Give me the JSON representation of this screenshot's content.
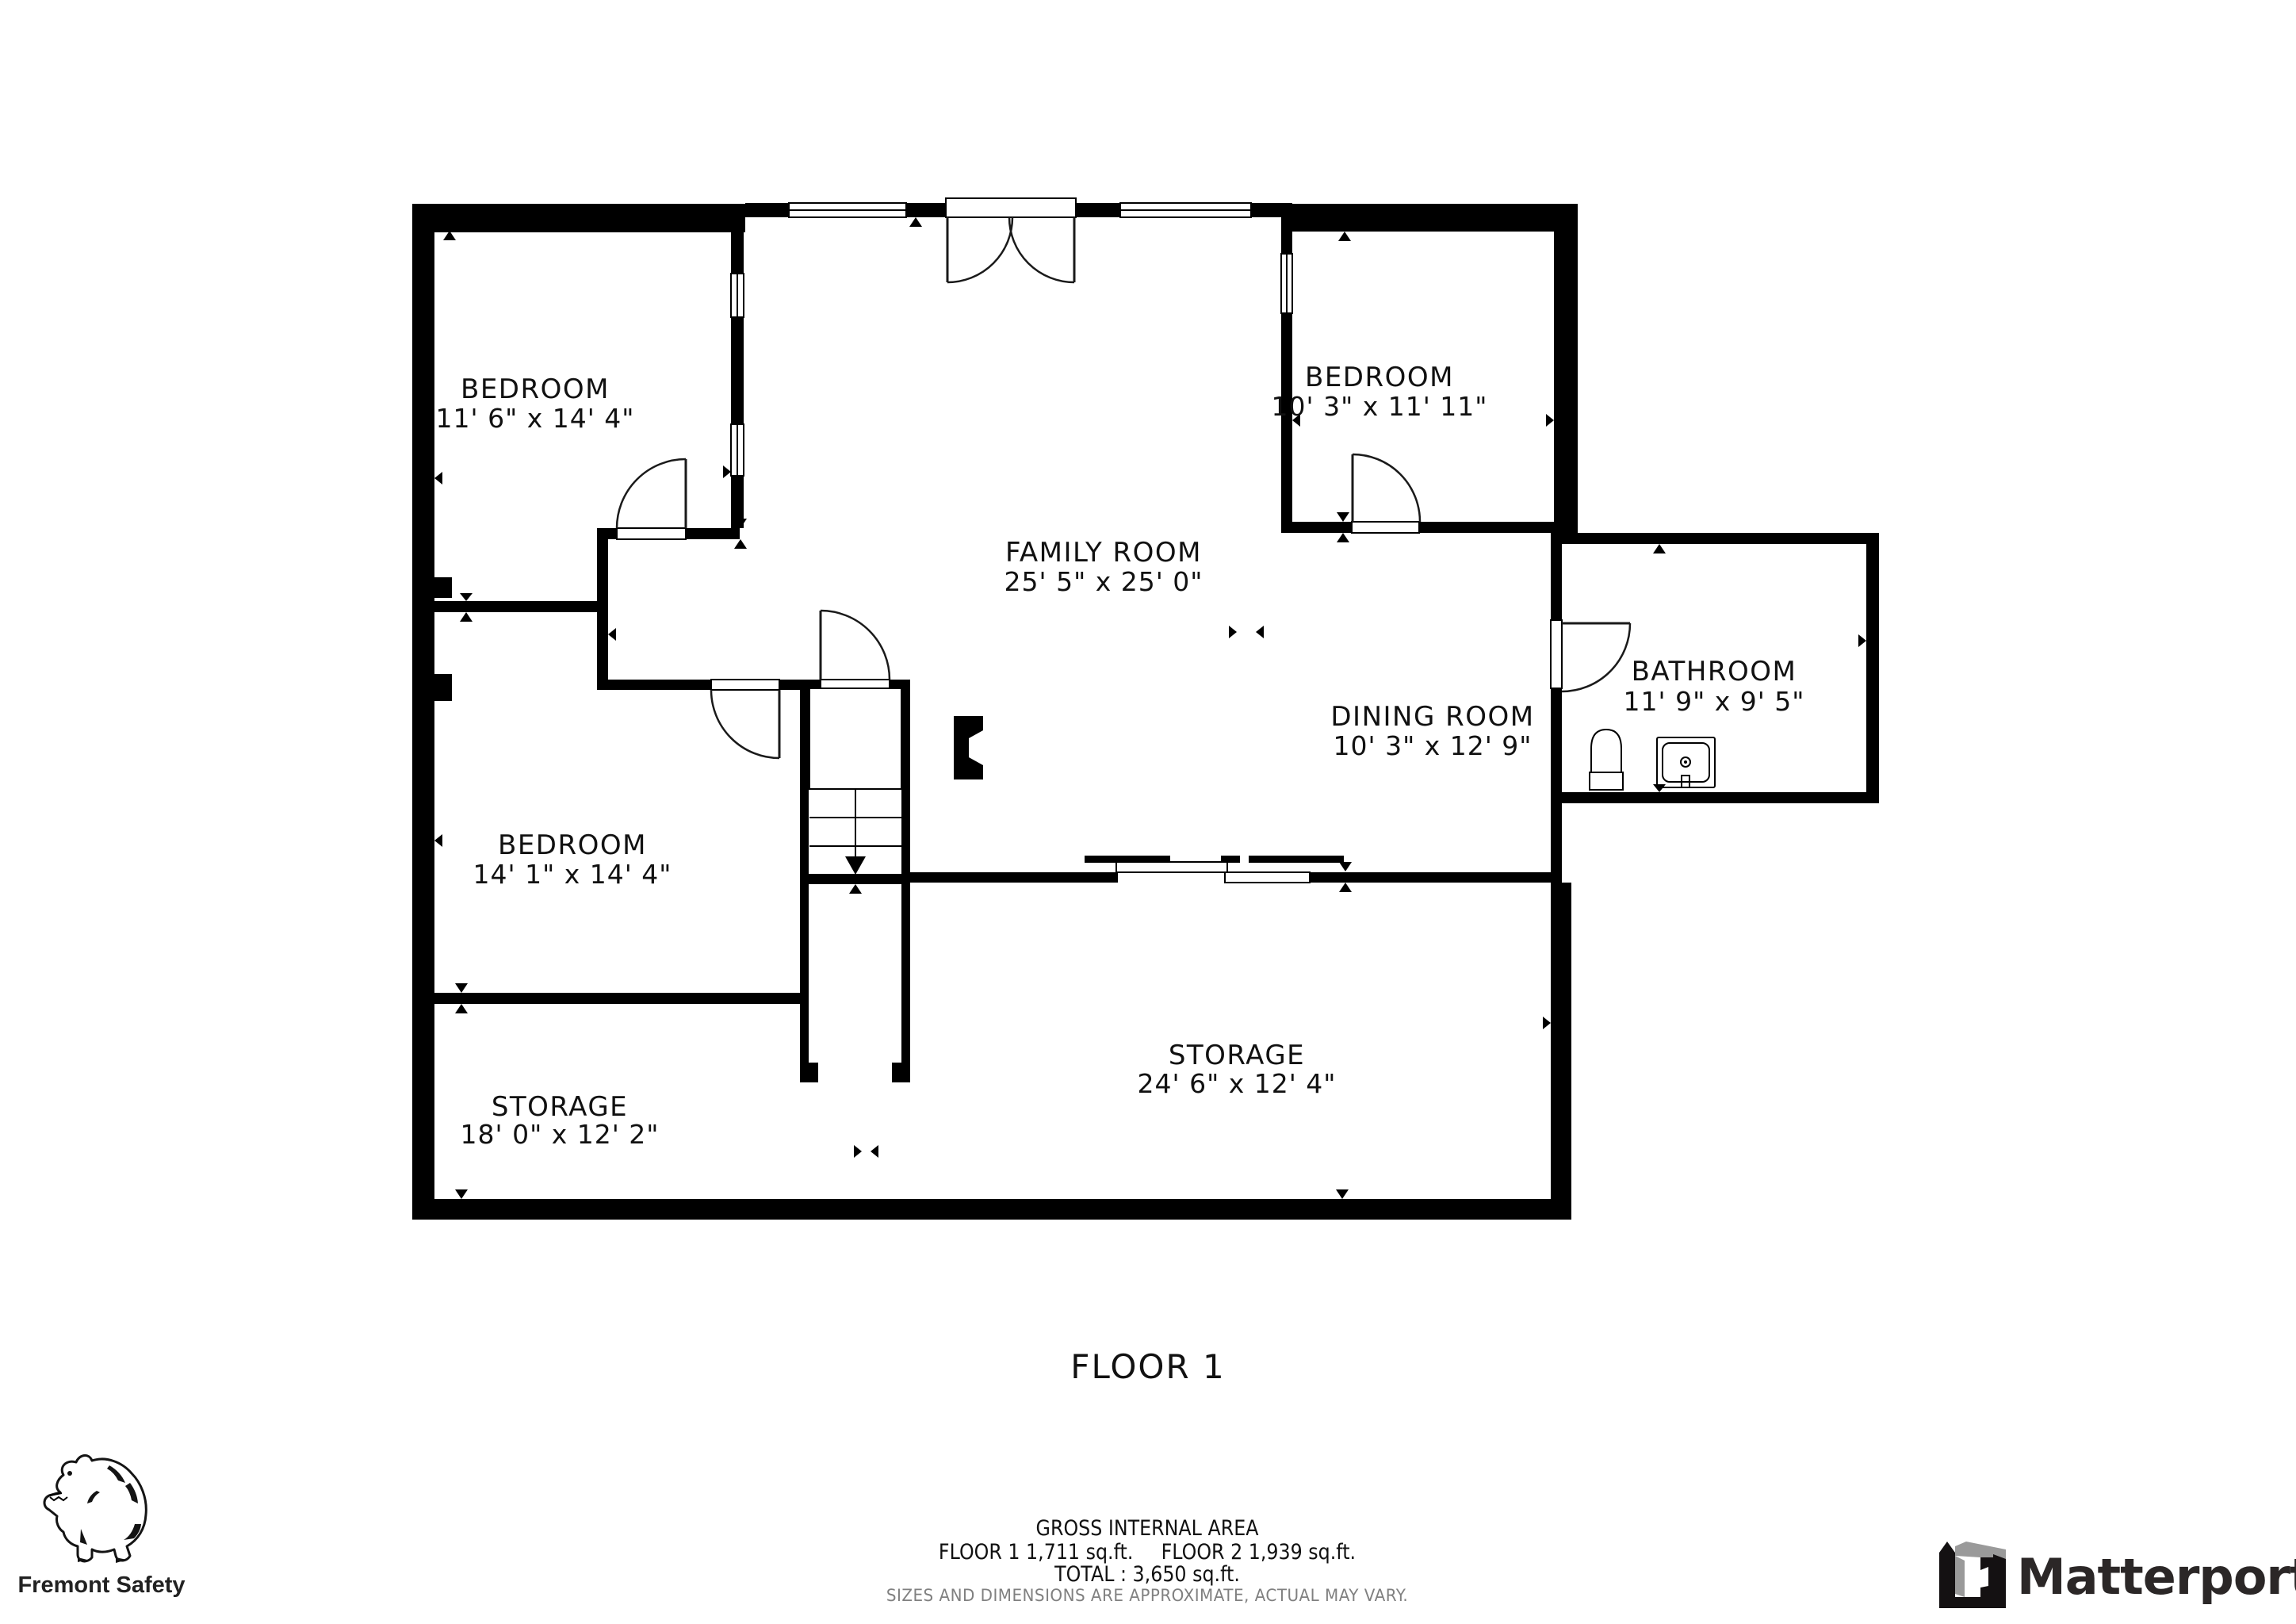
{
  "page": {
    "title": "FLOOR 1"
  },
  "rooms": {
    "bedroom_top_left": {
      "name": "BEDROOM",
      "dims": "11' 6\" x 14' 4\""
    },
    "bedroom_top_right": {
      "name": "BEDROOM",
      "dims": "10' 3\" x 11' 11\""
    },
    "family_room": {
      "name": "FAMILY ROOM",
      "dims": "25' 5\" x 25' 0\""
    },
    "dining_room": {
      "name": "DINING ROOM",
      "dims": "10' 3\" x 12' 9\""
    },
    "bathroom": {
      "name": "BATHROOM",
      "dims": "11' 9\" x 9' 5\""
    },
    "bedroom_left": {
      "name": "BEDROOM",
      "dims": "14' 1\" x 14' 4\""
    },
    "storage_left": {
      "name": "STORAGE",
      "dims": "18' 0\" x 12' 2\""
    },
    "storage_right": {
      "name": "STORAGE",
      "dims": "24' 6\" x 12' 4\""
    }
  },
  "footer": {
    "gross_area_title": "GROSS INTERNAL AREA",
    "floor1_area": "FLOOR 1 1,711 sq.ft.",
    "floor2_area": "FLOOR 2 1,939 sq.ft.",
    "total": "TOTAL :  3,650 sq.ft.",
    "disclaimer": "SIZES AND DIMENSIONS ARE APPROXIMATE, ACTUAL MAY VARY."
  },
  "branding": {
    "left_logo": "Fremont Safety",
    "right_logo": "Matterport"
  },
  "colors": {
    "walls": "#000000",
    "background": "#ffffff",
    "disclaimer_text": "#808080",
    "matterport_dark": "#2b2727",
    "matterport_gray": "#9a9a9a"
  }
}
